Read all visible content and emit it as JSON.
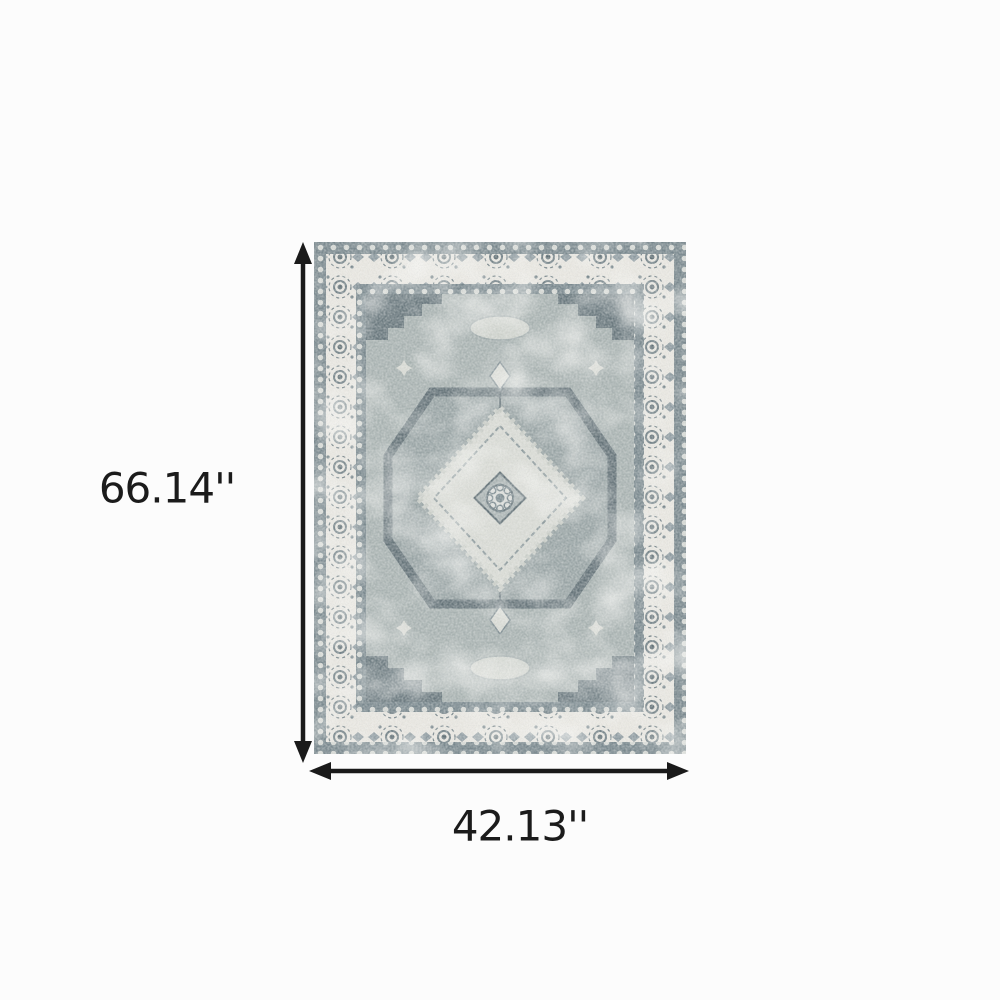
{
  "page": {
    "background_color": "#fcfcfc"
  },
  "diagram": {
    "height_label": "66.14''",
    "width_label": "42.13''",
    "arrow_color": "#1a1a1a",
    "label_color": "#1b1b1b",
    "rug_colors": {
      "ivory_border": "#e9e7e1",
      "guard_band": "#77868c",
      "guard_dots": "#dfe2dc",
      "field": "#a7b1b0",
      "dark_motif": "#5e6d73",
      "light_motif": "#d8dad4"
    }
  }
}
